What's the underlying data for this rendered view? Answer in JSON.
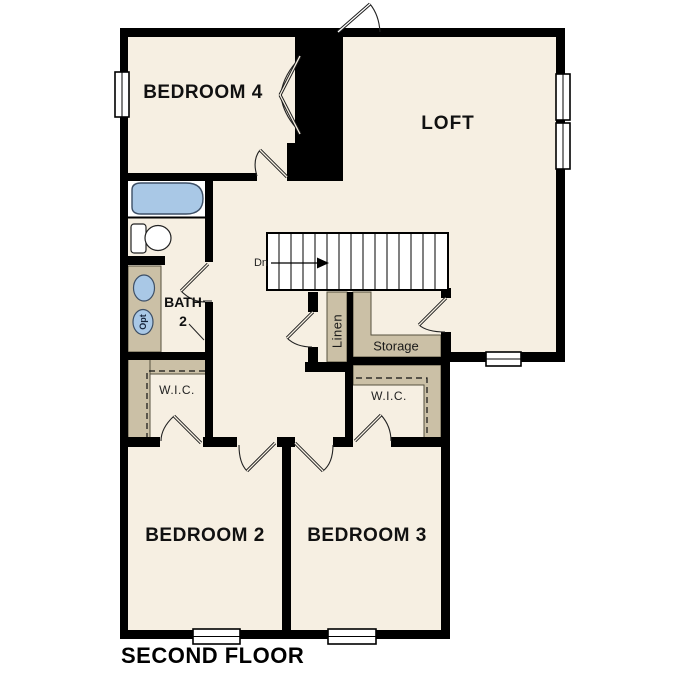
{
  "title": "SECOND FLOOR",
  "rooms": {
    "bedroom4": "BEDROOM 4",
    "loft": "LOFT",
    "bedroom2": "BEDROOM 2",
    "bedroom3": "BEDROOM 3",
    "bath2_line1": "BATH",
    "bath2_line2": "2",
    "wic_left": "W.I.C.",
    "wic_right": "W.I.C.",
    "linen": "Linen",
    "storage": "Storage"
  },
  "annotations": {
    "stairs_direction": "Dn",
    "optional_fixture": "Opt"
  },
  "colors": {
    "page_bg": "#ffffff",
    "floor": "#f6efe2",
    "wall": "#000000",
    "shelf_tan": "#cbc0a6",
    "fixture_blue": "#a9c8e6",
    "fixture_stroke": "#3d4f66"
  }
}
